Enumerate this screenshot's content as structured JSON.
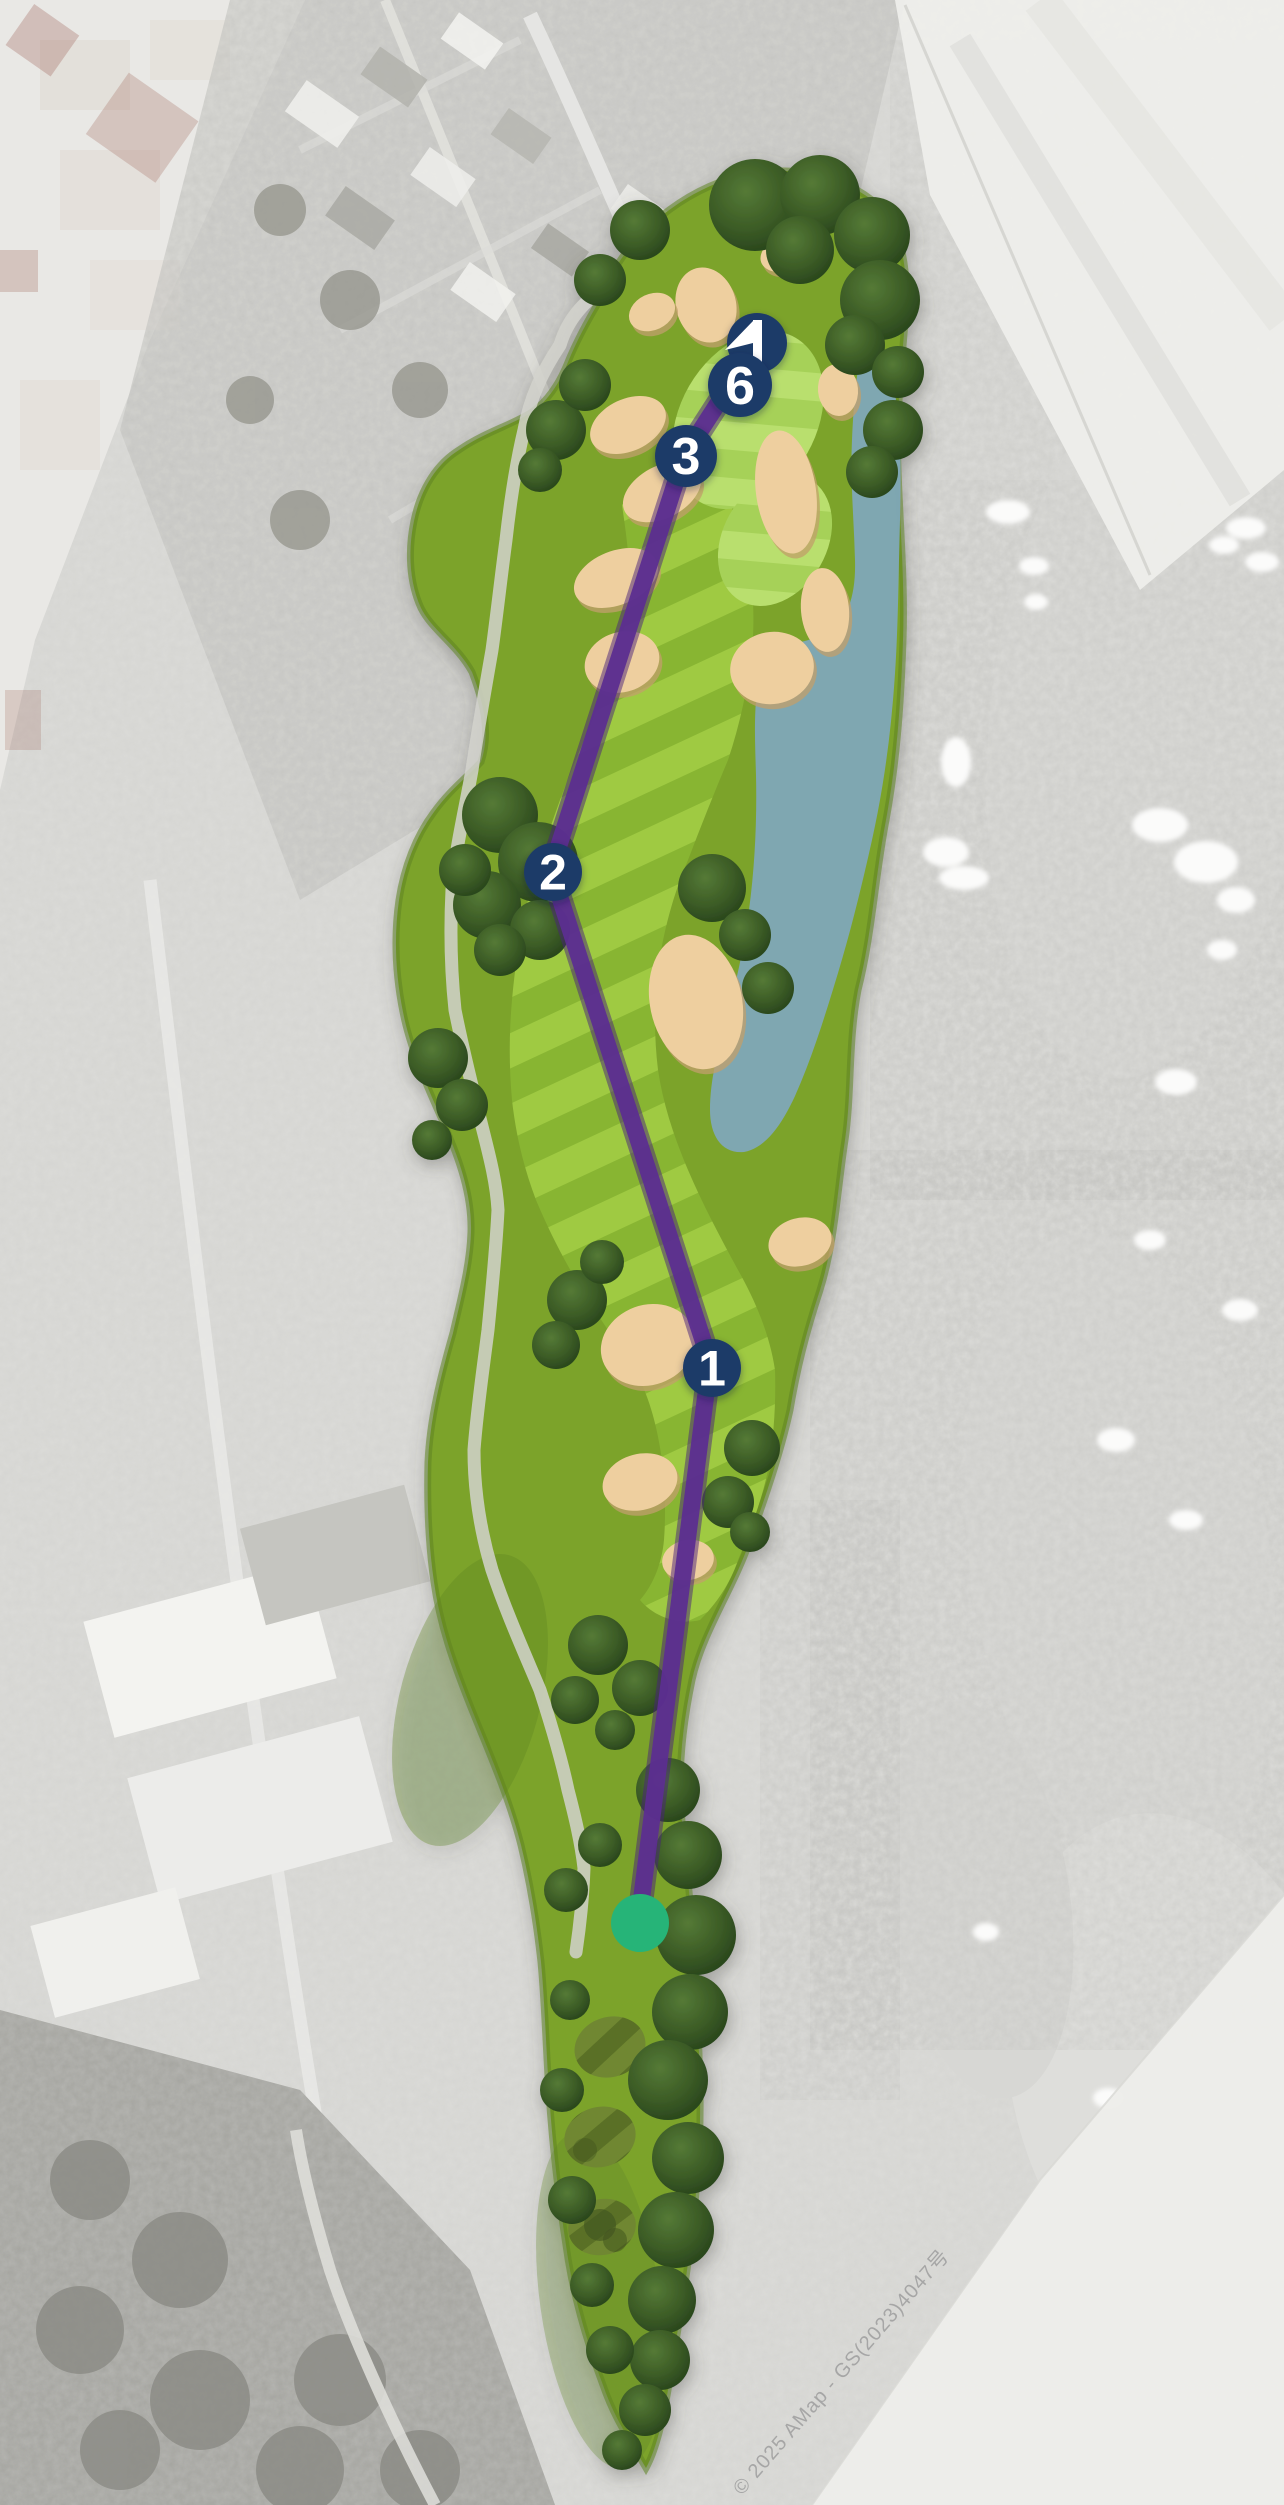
{
  "map": {
    "view": "golf-hole-aerial-map",
    "watermark": "© 2025 AMap - GS(2023)4047号",
    "markers": [
      {
        "id": "green-flag",
        "label": "",
        "kind": "flag"
      },
      {
        "id": "waypoint-6",
        "label": "6",
        "kind": "number"
      },
      {
        "id": "waypoint-3",
        "label": "3",
        "kind": "number"
      },
      {
        "id": "waypoint-2",
        "label": "2",
        "kind": "number"
      },
      {
        "id": "waypoint-1",
        "label": "1",
        "kind": "number"
      },
      {
        "id": "tee",
        "label": "",
        "kind": "tee-dot"
      }
    ],
    "colors": {
      "marker_navy": "#1e3a67",
      "marker_text": "#ffffff",
      "route_purple": "#5c2e90",
      "route_purple_dark": "#47227a",
      "tee_green": "#26b478",
      "water": "#7fa8b8",
      "sand": "#eecf9f",
      "sand_shadow": "#c29f6b",
      "fairway_light": "#9fca43",
      "fairway_dark": "#88b531",
      "rough": "#7ca32c",
      "rough_dark": "#5f8423",
      "green_light": "#b9df6e",
      "green_dark": "#a6d159",
      "tee_pad": "#5a7026",
      "tee_pad_stripe": "#6f8731",
      "cart_path": "#d2d2cd",
      "bg_base": "#dbdbd8",
      "watermark_text": "#9e9e9e"
    }
  }
}
